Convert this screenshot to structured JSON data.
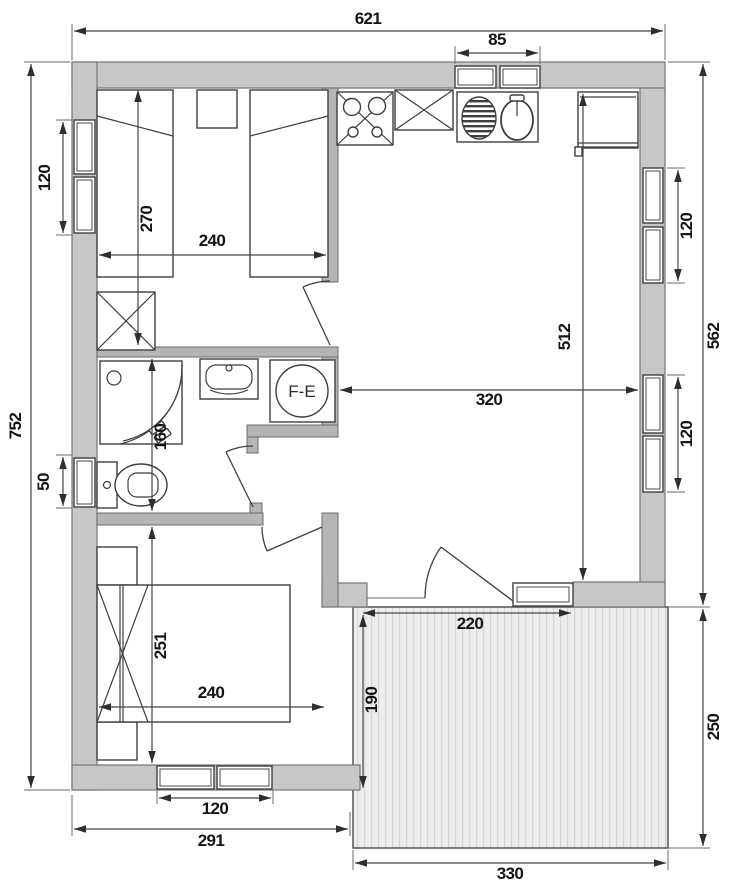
{
  "plan": {
    "water_heater_label": "F-E",
    "dims": {
      "total_width": "621",
      "kitchen_window": "85",
      "total_height": "752",
      "bedroom1_window": "120",
      "bedroom1_depth": "270",
      "bedroom1_width": "240",
      "right_outer_height": "562",
      "living_window_upper": "120",
      "living_depth": "512",
      "living_width": "320",
      "living_window_lower": "120",
      "wc_window": "50",
      "bathroom_depth": "160",
      "bedroom2_depth": "251",
      "bedroom2_width": "240",
      "bedroom2_window": "120",
      "house_bottom_width": "291",
      "terrace_span_top": "220",
      "terrace_inner_depth": "190",
      "terrace_outer_depth": "250",
      "terrace_width": "330"
    }
  }
}
